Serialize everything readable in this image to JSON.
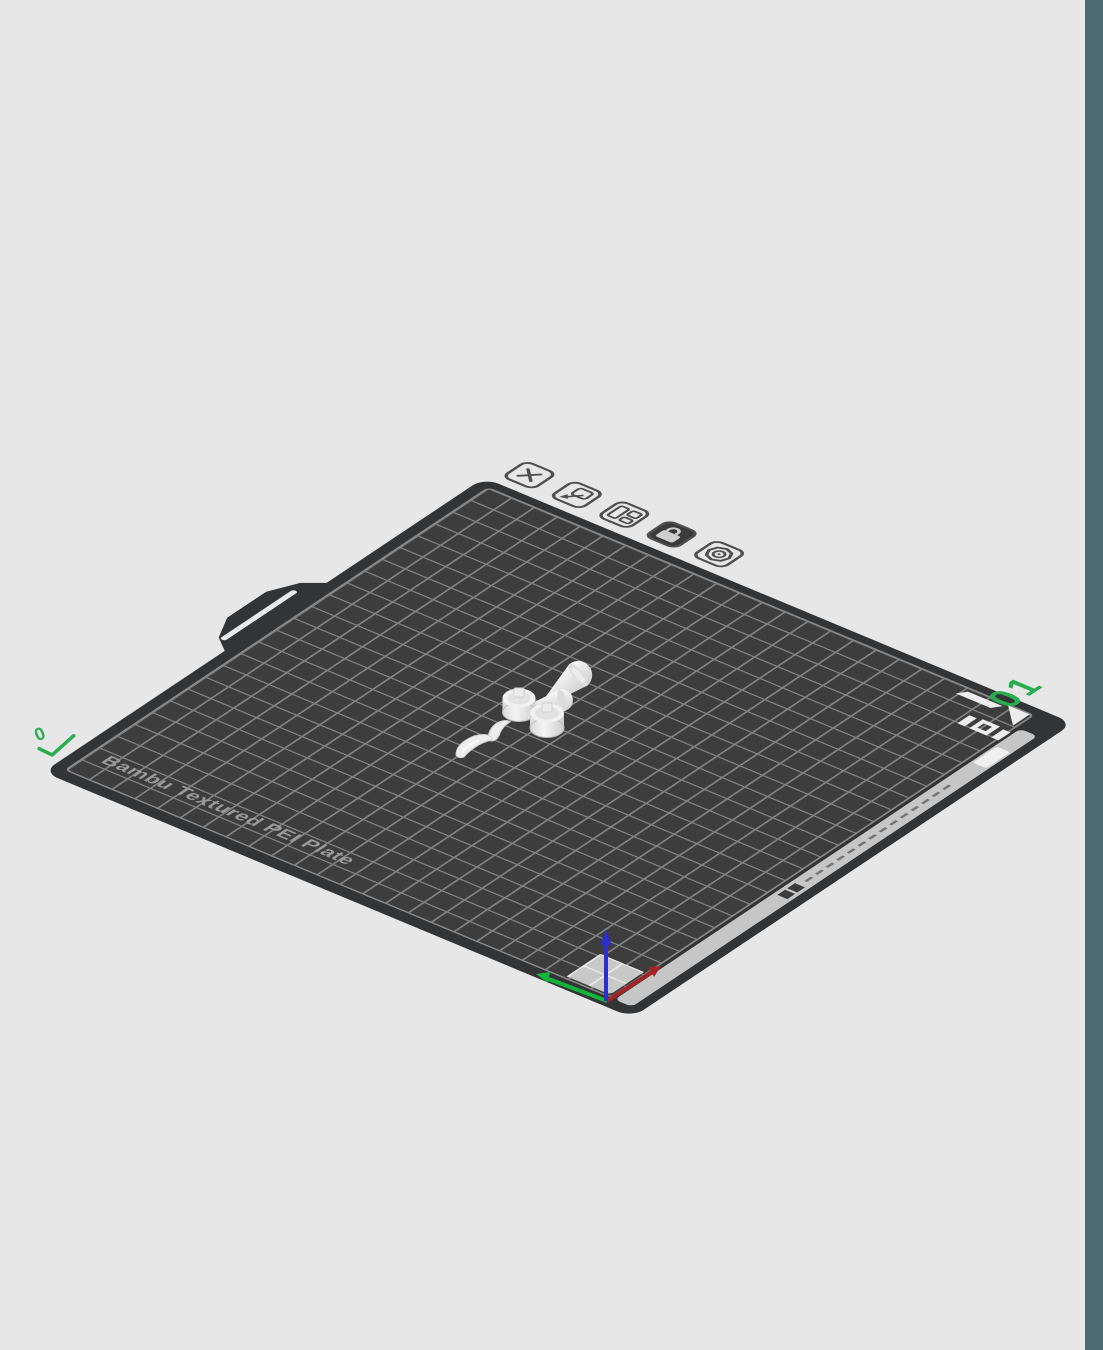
{
  "viewport": {
    "background_color": "#e7e7e7",
    "right_panel_color": "#4d6a73"
  },
  "plate": {
    "type_label": "Bambu Textured PEI Plate",
    "number": "01",
    "corner_mark": "0",
    "surface_color": "#3d3d3d",
    "grid_line_color": "#828282",
    "edge_strip_color": "#c6c6c6",
    "accent_green": "#27ae51",
    "lock_state": "locked"
  },
  "plate_toolbar": {
    "buttons": [
      {
        "name": "delete-plate",
        "icon": "x-icon"
      },
      {
        "name": "orient-plate",
        "icon": "orient-arrow-icon"
      },
      {
        "name": "arrange-plate",
        "icon": "arrange-grid-icon"
      },
      {
        "name": "lock-plate",
        "icon": "lock-icon",
        "state": "locked"
      },
      {
        "name": "plate-settings",
        "icon": "gear-icon"
      }
    ]
  },
  "axes_indicator": {
    "x_axis_color": "#a32525",
    "y_axis_color": "#12b53a",
    "z_axis_color": "#2e2ec9"
  },
  "models": [
    {
      "name": "cone-large"
    },
    {
      "name": "cone-small"
    },
    {
      "name": "knob-left"
    },
    {
      "name": "knob-right"
    },
    {
      "name": "claw-small"
    },
    {
      "name": "claw-large"
    }
  ]
}
